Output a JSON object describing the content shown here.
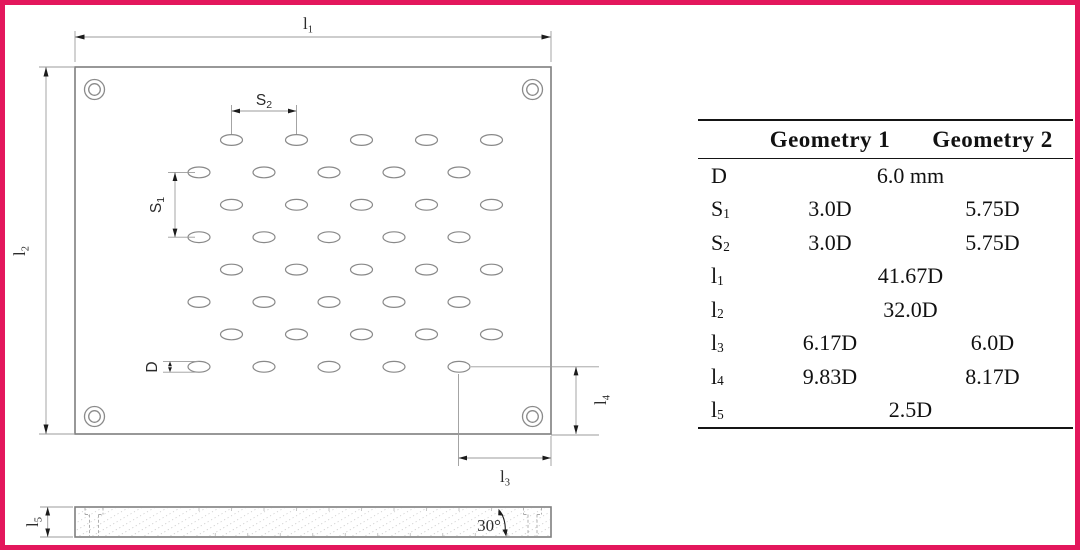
{
  "frame": {
    "border_color": "#E3175C",
    "background": "#ffffff"
  },
  "drawing": {
    "labels": {
      "l1": {
        "main": "l",
        "sub": "1"
      },
      "l2": {
        "main": "l",
        "sub": "2"
      },
      "l3": {
        "main": "l",
        "sub": "3"
      },
      "l4": {
        "main": "l",
        "sub": "4"
      },
      "l5": {
        "main": "l",
        "sub": "5"
      },
      "s1": {
        "main": "S",
        "sub": "1"
      },
      "s2": {
        "main": "S",
        "sub": "2"
      },
      "d": {
        "main": "D",
        "sub": ""
      },
      "angle": "30°"
    },
    "hole_grid": {
      "rows": 8,
      "cols": 5,
      "row_start_y": 135,
      "row_dy": 32.4,
      "odd_row_start_x": 226.5,
      "even_row_start_x": 194,
      "col_dx": 65,
      "hole_rx": 11,
      "hole_ry": 5.4
    },
    "side_view": {
      "x": 70,
      "y": 502,
      "width": 476,
      "height": 30,
      "hatch_step": 13
    },
    "colors": {
      "outline": "#7f7f7f",
      "dimension": "#9b9b9b",
      "arrow": "#1c1c1c",
      "hatch": "#cbcbcb"
    }
  },
  "table": {
    "headers": {
      "geo1": "Geometry 1",
      "geo2": "Geometry 2"
    },
    "rows": [
      {
        "label": "D",
        "sub": "",
        "span": "6.0 mm"
      },
      {
        "label": "S",
        "sub": "1",
        "geo1": "3.0D",
        "geo2": "5.75D"
      },
      {
        "label": "S",
        "sub": "2",
        "geo1": "3.0D",
        "geo2": "5.75D"
      },
      {
        "label": "l",
        "sub": "1",
        "span": "41.67D"
      },
      {
        "label": "l",
        "sub": "2",
        "span": "32.0D"
      },
      {
        "label": "l",
        "sub": "3",
        "geo1": "6.17D",
        "geo2": "6.0D"
      },
      {
        "label": "l",
        "sub": "4",
        "geo1": "9.83D",
        "geo2": "8.17D"
      },
      {
        "label": "l",
        "sub": "5",
        "span": "2.5D"
      }
    ]
  }
}
